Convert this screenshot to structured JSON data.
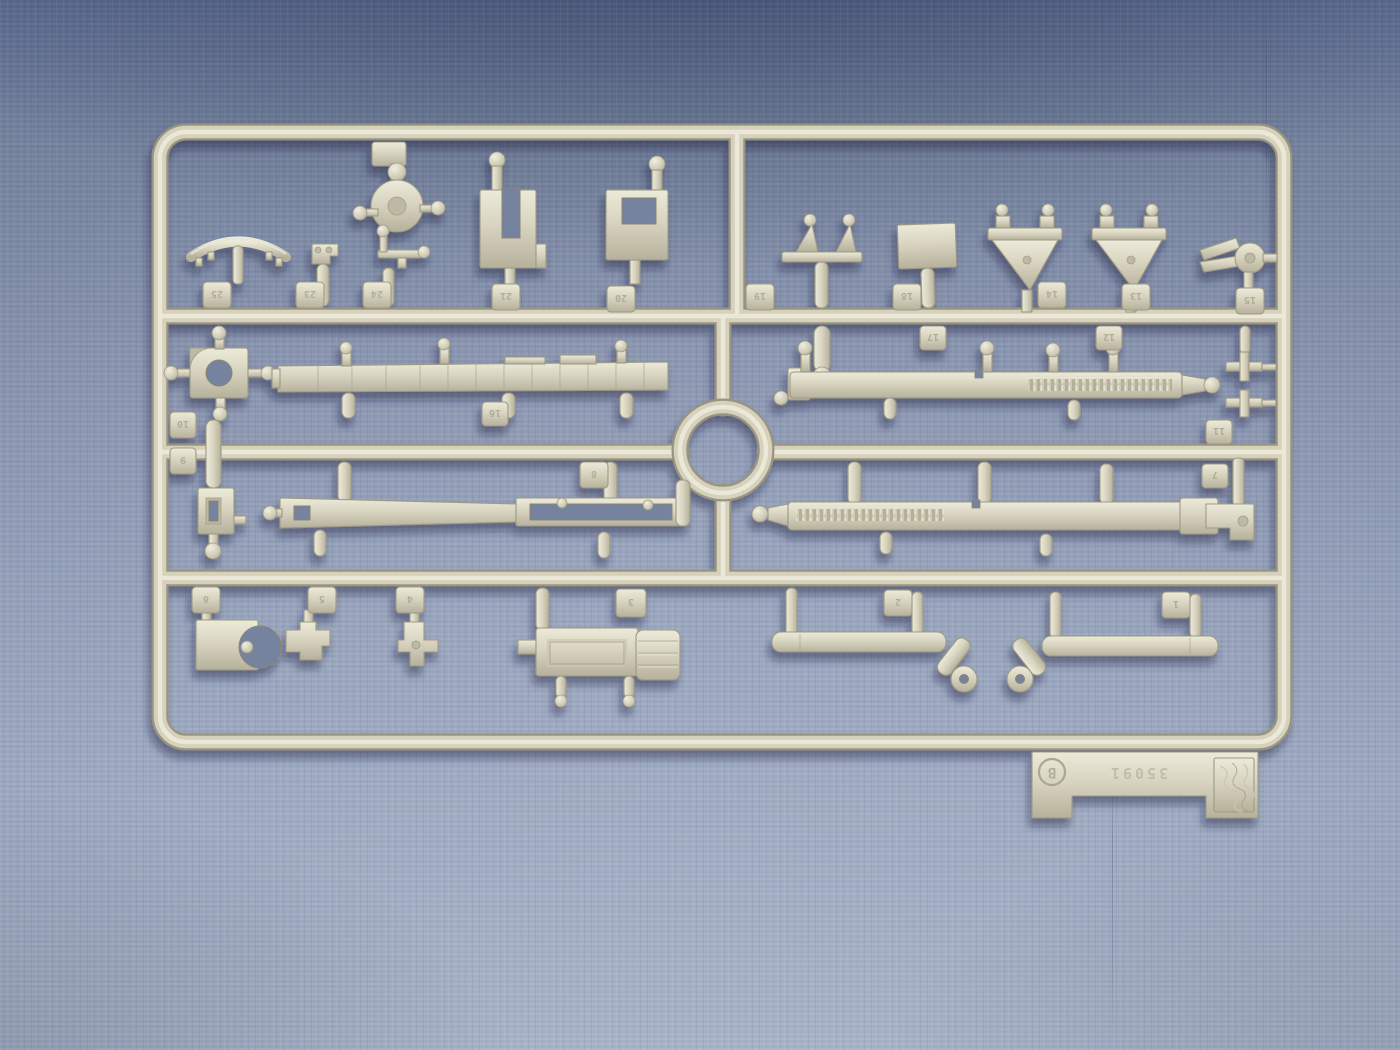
{
  "scene": {
    "caption": "Light grey-tan plastic model kit sprue photographed on blue fabric",
    "sprue_letter": "B"
  },
  "sprue": {
    "tag": {
      "letter": "B",
      "code": "35091"
    },
    "tabs": [
      {
        "label": "25"
      },
      {
        "label": "23"
      },
      {
        "label": "24"
      },
      {
        "label": "21"
      },
      {
        "label": "20"
      },
      {
        "label": "19"
      },
      {
        "label": "18"
      },
      {
        "label": "14"
      },
      {
        "label": "13"
      },
      {
        "label": "15"
      },
      {
        "label": "17"
      },
      {
        "label": "12"
      },
      {
        "label": "10"
      },
      {
        "label": "9"
      },
      {
        "label": "8"
      },
      {
        "label": "16"
      },
      {
        "label": "11"
      },
      {
        "label": "7"
      },
      {
        "label": "6"
      },
      {
        "label": "5"
      },
      {
        "label": "4"
      },
      {
        "label": "3"
      },
      {
        "label": "2"
      },
      {
        "label": "1"
      }
    ]
  },
  "colors": {
    "plastic_mid": "#d6d2bd",
    "plastic_light": "#ecead9",
    "plastic_edge": "#9d9984",
    "fabric_top": "#5e6d92",
    "fabric_mid": "#8793ae",
    "fabric_bottom": "#a9b5c9",
    "shadow": "#141d3a"
  }
}
